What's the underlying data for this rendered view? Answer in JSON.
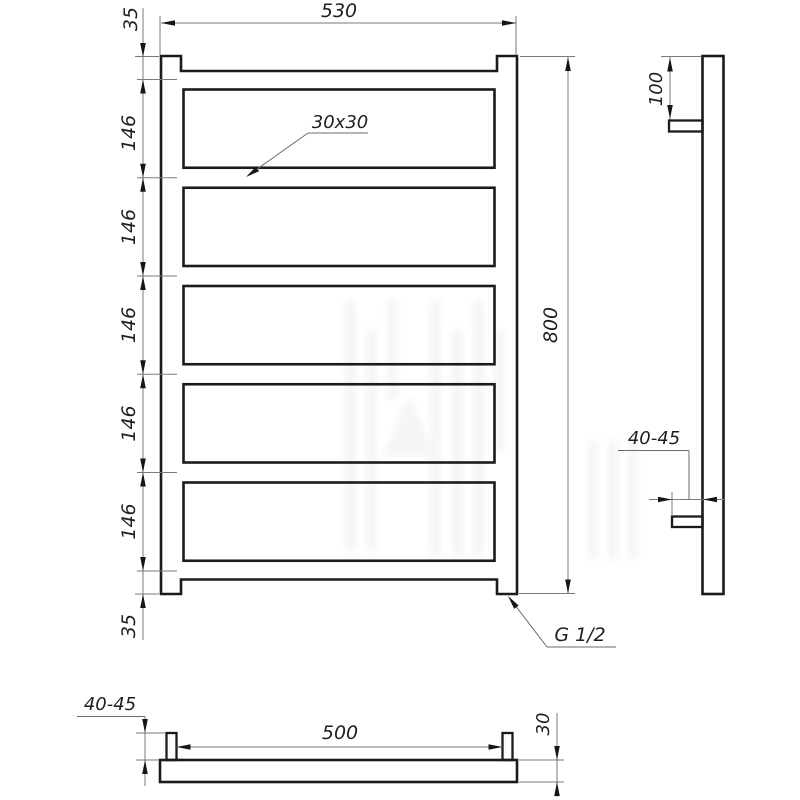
{
  "colors": {
    "background": "#ffffff",
    "outline": "#1b1b1b",
    "dimension_lines": "#7a7a7a",
    "text": "#1f1f1f"
  },
  "front_view": {
    "width_dim": "530",
    "height_dim": "800",
    "top_margin_dim": "35",
    "bottom_margin_dim": "35",
    "rung_spacing_dims": [
      "146",
      "146",
      "146",
      "146",
      "146"
    ],
    "profile_label": "30x30",
    "thread_label": "G 1/2"
  },
  "side_view": {
    "top_bracket_dim": "100",
    "wall_clearance_dim": "40-45"
  },
  "bottom_view": {
    "bracket_spacing_dim": "500",
    "depth_dim": "30",
    "wall_clearance_dim": "40-45"
  }
}
